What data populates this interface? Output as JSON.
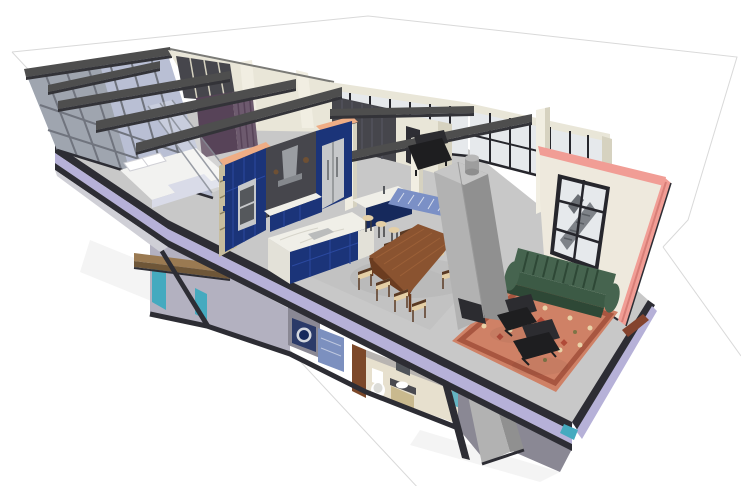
{
  "view": {
    "kind": "3d-model-cutaway-render",
    "style": "sketchup-perspective",
    "subject": "loft-apartment-section",
    "background": "white",
    "visible_text": "none"
  },
  "palette": {
    "bg": "#ffffff",
    "ground_line": "#d9d9d9",
    "floor": "#c8c8c8",
    "floor_shade": "#bdbdbd",
    "slab_cut": "#b6b1d8",
    "edge_dark": "#2d2d34",
    "steel": "#4e4e4e",
    "steel_dark": "#333338",
    "cream": "#e9e6d8",
    "cream_shade": "#d6d2c0",
    "cream_bright": "#f1eee2",
    "mullion": "#26262c",
    "mullion_soft": "#70747e",
    "pane": "#e6e9ec",
    "pane_left": "#b9bfd4",
    "mesh": "#9aa0a8",
    "navy": "#1b3479",
    "navy_light": "#2b49a0",
    "navy_dark": "#16295c",
    "peach": "#efad85",
    "marble": "#f0efe8",
    "marble_shade": "#e3e1d8",
    "marble_vein": "#d6d4ca",
    "appliance": "#c6c8ca",
    "hood": "#9a9da2",
    "alcove": "#46464c",
    "walnut": "#8a5330",
    "walnut_dark": "#6b3c20",
    "chair_wood": "#5a3a24",
    "cushion": "#e4cfa6",
    "concrete": "#b2b2b2",
    "concrete_side": "#909090",
    "concrete_top": "#c6c6c6",
    "sofa": "#3c5a45",
    "sofa_dark": "#2e4836",
    "sofa_light": "#46644f",
    "rug": "#cf8166",
    "rug_border": "#a85640",
    "rug_cream": "#e9d2a8",
    "rug_olive": "#7e7446",
    "rug_red": "#b04a38",
    "black": "#1e1e20",
    "black_soft": "#2c2c30",
    "wall_cream": "#eee9dd",
    "pink": "#f19d95",
    "pink_dark": "#d87e77",
    "teal": "#45aabf",
    "runner": "#7b90c6",
    "washer": "#2b3a68",
    "door_brown": "#7c4829",
    "deck": "#9a7a52",
    "deck_dark": "#6e5638",
    "plum": "#574358",
    "curtain": "#6d5a6e",
    "bed": "#f2f2f0",
    "bed_shade": "#d9dbe8",
    "lower_wall": "#b3b1c0",
    "lower_shadow": "#8a8894",
    "bath_cream": "#e7e0ce",
    "rust": "#84432e",
    "tile_blue": "#7c90bf",
    "glass_frame": "#8a8f98",
    "shelf_line": "#8a8060",
    "white": "#ffffff"
  },
  "scene": {
    "upper_level": {
      "bedroom": [
        "bed",
        "pillows",
        "bench",
        "glass-partition",
        "plum-accent-wall",
        "curtains",
        "wardrobe"
      ],
      "kitchen": [
        "open-shelf-end",
        "tall-navy-cabinets",
        "wall-ovens",
        "range-hood",
        "fridge",
        "marble-island",
        "bar-island",
        "bar-stools"
      ],
      "dining": [
        "walnut-table",
        "wood-chairs"
      ],
      "living": [
        "green-channel-sofa",
        "oriental-rug",
        "lounge-chairs",
        "concrete-fireplace-chimney",
        "blue-runner",
        "armchair"
      ],
      "envelope": [
        "left-glass-wall",
        "steel-beams",
        "clerestory-windows",
        "cream-columns",
        "section-cut-wall-pink"
      ]
    },
    "lower_level": {
      "rooms": [
        "hallway",
        "laundry-washer",
        "bathroom"
      ],
      "objects": [
        "toilet",
        "vanity-basin",
        "wood-door",
        "blue-tile-panel",
        "teal-glass",
        "wood-deck",
        "concrete-pier"
      ]
    }
  }
}
